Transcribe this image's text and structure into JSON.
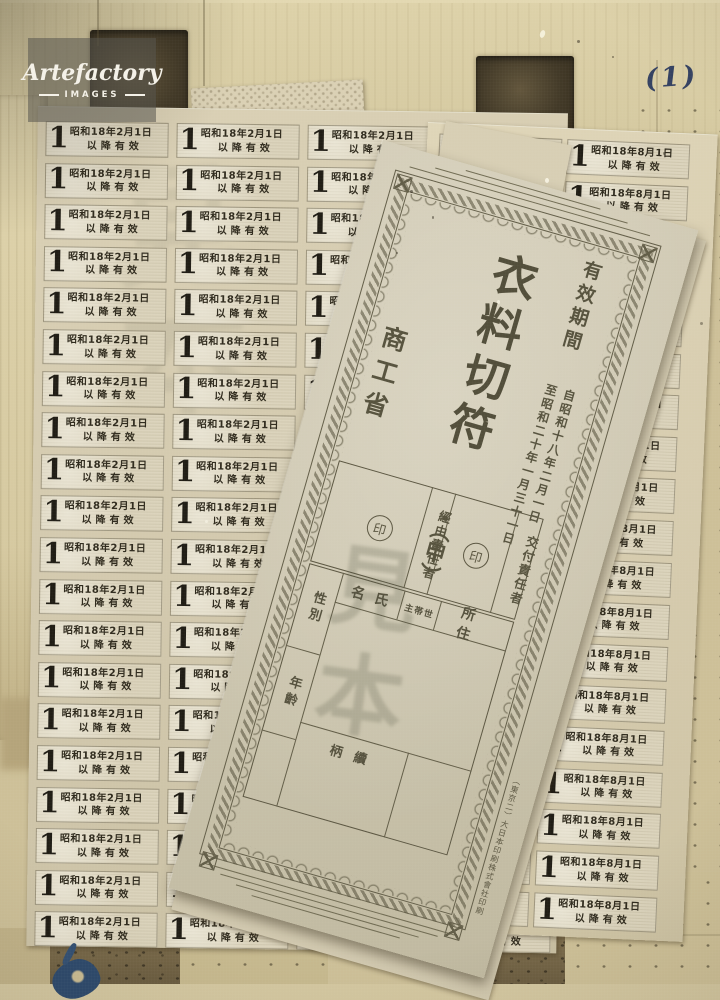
{
  "watermark": {
    "brand": "Artefactory",
    "subtitle": "IMAGES"
  },
  "handwritten_note": "(1)",
  "sheets": {
    "left": {
      "denomination": "1",
      "date_line": "昭和18年2月1日",
      "valid_line": "以降有效",
      "rows": 20,
      "cols": 4
    },
    "right": {
      "denomination": "1",
      "date_line": "昭和18年8月1日",
      "valid_line": "以降有效",
      "rows": 19,
      "cols": 2
    }
  },
  "certificate": {
    "title": "衣料切符",
    "class_mark": "・（甲）",
    "ministry": "商工省",
    "validity": {
      "heading": "有效期間",
      "from": "自昭和十八年二月一日",
      "to": "至昭和二十年一月三十一日"
    },
    "seal_boxes": {
      "via": "經由責任者",
      "issue": "交付責任者",
      "seal": "印"
    },
    "form": {
      "address": "所住",
      "household_head": "主帯世",
      "name": "名氏",
      "sex": "性別",
      "age": "年齡",
      "relation": "柄續"
    },
    "specimen": "見本",
    "printer": "（東京二）大日本印刷株式會社印刷"
  },
  "colors": {
    "wood": "#cdc099",
    "sheet_paper": "#d6cdb3",
    "certificate_paper": "#ccc6b1",
    "print_ink": "#4f4c3a",
    "stamp_ink": "#1a1812",
    "note_ink": "#2b3a5f",
    "watermark_bg": "rgba(88,86,78,0.55)"
  }
}
